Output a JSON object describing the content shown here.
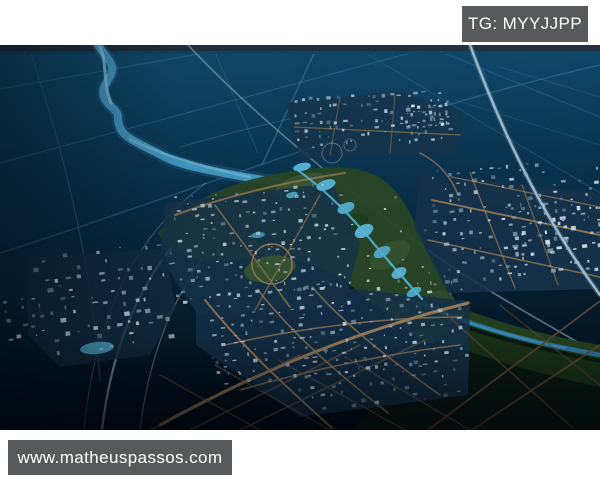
{
  "overlay": {
    "tg_label": "TG: MYYJJPP",
    "site_label": "www.matheuspassos.com"
  },
  "palette": {
    "page_bg": "#ffffff",
    "badge_bg": "#58595b",
    "badge_text": "#ffffff",
    "water_deep": "#0a3450",
    "river_blue": "#4aa4d2",
    "lake_cyan": "#5fc0e4",
    "park_green": "#2b4827",
    "city_road_tan": "#a8845c",
    "highway_light": "#aac8dc",
    "building_light": "#cfe0ec"
  },
  "scene": {
    "w": 600,
    "h": 385,
    "layers": [
      {
        "t": "lg",
        "id": "bgG",
        "x1": 0,
        "y1": 0,
        "x2": 0.12,
        "y2": 1,
        "st": [
          [
            0,
            "#125273",
            1
          ],
          [
            0.2,
            "#0e4362",
            1
          ],
          [
            0.4,
            "#0a3450",
            1
          ],
          [
            0.62,
            "#07263a",
            1
          ],
          [
            0.82,
            "#041827",
            1
          ],
          [
            1,
            "#020d16",
            1
          ]
        ]
      },
      {
        "t": "lg",
        "id": "fadeB",
        "x1": 0,
        "y1": 0,
        "x2": 0,
        "y2": 1,
        "st": [
          [
            0,
            "#000208",
            0
          ],
          [
            1,
            "#000208",
            0.6
          ]
        ]
      },
      {
        "t": "lg",
        "id": "fadeL",
        "x1": 0,
        "y1": 0,
        "x2": 1,
        "y2": 0,
        "st": [
          [
            0,
            "#000812",
            0.5
          ],
          [
            0.3,
            "#000812",
            0.1
          ],
          [
            1,
            "#000812",
            0
          ]
        ]
      },
      {
        "t": "r",
        "x": 0,
        "y": 0,
        "w": 600,
        "h": 385,
        "f": "url(#bgG)"
      },
      {
        "t": "p",
        "d": "M0,44 L250,0",
        "s": "#337aa0",
        "w": 1.2,
        "o": 0.5
      },
      {
        "t": "p",
        "d": "M0,118 L440,0",
        "s": "#337aa0",
        "w": 1.2,
        "o": 0.5
      },
      {
        "t": "p",
        "d": "M0,208 C160,158 380,70 600,20",
        "s": "#337aa0",
        "w": 1.4,
        "o": 0.55
      },
      {
        "t": "p",
        "d": "M28,0 C66,110 92,225 100,335",
        "s": "#337aa0",
        "w": 1.2,
        "o": 0.5
      },
      {
        "t": "p",
        "d": "M212,0 L258,108",
        "s": "#337aa0",
        "w": 1,
        "o": 0.45
      },
      {
        "t": "p",
        "d": "M318,0 L262,120",
        "s": "#6a92ac",
        "w": 1.2,
        "o": 0.5
      },
      {
        "t": "p",
        "d": "M425,0 L600,72",
        "s": "#337aa0",
        "w": 1,
        "o": 0.45
      },
      {
        "t": "p",
        "d": "M352,0 L600,148",
        "s": "#337aa0",
        "w": 1,
        "o": 0.4
      },
      {
        "t": "p",
        "d": "M500,22 L600,52",
        "s": "#337aa0",
        "w": 1,
        "o": 0.35
      },
      {
        "t": "p",
        "d": "M455,55 L600,100",
        "s": "#337aa0",
        "w": 1,
        "o": 0.3
      },
      {
        "t": "p",
        "d": "M180,102 C240,85 300,70 360,60",
        "s": "#3d82a8",
        "w": 1.1,
        "o": 0.45
      },
      {
        "t": "r",
        "x": 0,
        "y": 0,
        "w": 600,
        "h": 6,
        "f": "#223140"
      },
      {
        "t": "r",
        "x": 0,
        "y": 6,
        "w": 600,
        "h": 3,
        "f": "#0d4668",
        "o": 0.85
      },
      {
        "t": "p",
        "d": "M98,0 C104,10 114,18 112,26 C110,36 100,42 104,52 C108,62 118,64 118,72 C118,82 122,88 128,92 C136,98 150,104 165,112 C185,122 215,126 245,132 C262,135 272,136 282,138",
        "s": "#2d6e96",
        "w": 13,
        "o": 0.4
      },
      {
        "t": "p",
        "d": "M98,0 C104,10 114,18 112,26 C110,36 100,42 104,52 C108,62 118,64 118,72 C118,82 122,88 128,92 C136,98 150,104 165,112 C185,122 215,126 245,132 C262,135 272,136 282,138",
        "s": "#4aa4d2",
        "w": 8,
        "o": 0.95
      },
      {
        "t": "p",
        "d": "M100,2 C107,16 103,40 111,58",
        "s": "#8ed2ee",
        "w": 3,
        "o": 0.8
      },
      {
        "t": "p",
        "d": "M130,94 C152,106 200,122 250,132",
        "s": "#7cc6e6",
        "w": 2.5,
        "o": 0.7
      },
      {
        "t": "p",
        "d": "M228,148 C162,196 115,272 102,385",
        "s": "#9db9cc",
        "w": 2.2,
        "o": 0.8
      },
      {
        "t": "p",
        "d": "M252,160 C196,206 152,282 140,385",
        "s": "#9db9cc",
        "w": 1.2,
        "o": 0.5
      },
      {
        "t": "p",
        "d": "M206,138 C140,186 96,262 84,385",
        "s": "#9db9cc",
        "w": 1,
        "o": 0.4
      },
      {
        "t": "p",
        "d": "M188,0 C250,66 330,132 424,202 C475,240 545,278 600,310",
        "s": "#97b4c8",
        "w": 1.8,
        "o": 0.55
      },
      {
        "t": "p",
        "d": "M158,188 C190,152 240,134 292,126 C330,120 362,120 382,134 C402,148 412,172 424,196 C436,220 450,246 462,268 C470,282 474,292 476,302 C458,308 432,302 412,288 C392,274 368,254 348,238 C316,214 276,208 238,214 C206,219 172,212 158,188 Z",
        "f": "#2b4827",
        "o": 0.96
      },
      {
        "t": "e",
        "cx": 300,
        "cy": 140,
        "rx": 26,
        "ry": 10,
        "rot": -18,
        "f": "#41613a",
        "o": 0.7
      },
      {
        "t": "e",
        "cx": 390,
        "cy": 210,
        "rx": 22,
        "ry": 12,
        "rot": -30,
        "f": "#3b5a34",
        "o": 0.7
      },
      {
        "t": "e",
        "cx": 432,
        "cy": 258,
        "rx": 18,
        "ry": 10,
        "rot": -32,
        "f": "#35532f",
        "o": 0.7
      },
      {
        "t": "e",
        "cx": 350,
        "cy": 180,
        "rx": 20,
        "ry": 9,
        "rot": -25,
        "f": "#1e3a1c",
        "o": 0.6
      },
      {
        "t": "e",
        "cx": 255,
        "cy": 205,
        "rx": 24,
        "ry": 9,
        "rot": -8,
        "f": "#365433",
        "o": 0.6
      },
      {
        "t": "p",
        "d": "M352,385 L462,268 L600,302 L600,385 Z",
        "f": "#0a1a10",
        "o": 0.92
      },
      {
        "t": "p",
        "d": "M428,248 C470,268 520,286 600,300 L600,314 C520,298 468,282 420,264 Z",
        "f": "#26451f",
        "o": 0.9
      },
      {
        "t": "p",
        "d": "M420,268 C470,288 530,304 600,318 L600,342 C525,326 462,306 408,284 Z",
        "f": "#1c3417",
        "o": 0.9
      },
      {
        "t": "p",
        "d": "M420,258 C460,276 510,292 560,302 C575,305 590,308 600,310",
        "s": "#2c76a4",
        "w": 4.5,
        "o": 0.95
      },
      {
        "t": "p",
        "d": "M430,264 C470,280 520,294 565,303",
        "s": "#4696c2",
        "w": 1.8,
        "o": 0.7
      },
      {
        "t": "p",
        "d": "M286,58 L395,46 L462,66 L458,108 L300,114 Z",
        "f": "#17364e",
        "o": 0.85
      },
      {
        "t": "p",
        "d": "M420,128 L600,148 L600,244 L448,248 L414,182 Z",
        "f": "#16344c",
        "o": 0.85
      },
      {
        "t": "p",
        "d": "M165,158 L332,138 L360,198 L344,262 L198,270 L160,212 Z",
        "f": "#17364e",
        "o": 0.85
      },
      {
        "t": "p",
        "d": "M196,252 L345,243 L470,256 L468,350 L300,372 L240,330 L196,300 Z",
        "f": "#15324a",
        "o": 0.85
      },
      {
        "t": "p",
        "d": "M26,212 L164,204 L176,262 L150,310 L60,322 L28,290 Z",
        "f": "#152f45",
        "o": 0.8
      },
      {
        "t": "e",
        "cx": 270,
        "cy": 224,
        "rx": 26,
        "ry": 13,
        "rot": -10,
        "f": "#3c5c33",
        "o": 0.9
      },
      {
        "t": "c",
        "cx": 272,
        "cy": 219,
        "r": 20,
        "s": "#a8845c",
        "w": 1.4,
        "o": 0.9
      },
      {
        "t": "p",
        "d": "M160,380 C260,325 360,285 468,258",
        "s": "#a8845c",
        "w": 3,
        "o": 0.9
      },
      {
        "t": "p",
        "d": "M205,255 C245,305 290,345 332,383",
        "s": "#a8845c",
        "w": 2,
        "o": 0.85
      },
      {
        "t": "p",
        "d": "M258,245 C295,292 340,330 388,368",
        "s": "#9a7a52",
        "w": 1.6,
        "o": 0.8
      },
      {
        "t": "p",
        "d": "M312,242 C350,285 395,318 440,350",
        "s": "#9a7a52",
        "w": 1.6,
        "o": 0.8
      },
      {
        "t": "p",
        "d": "M225,300 C290,285 380,272 462,272",
        "s": "#9a7a52",
        "w": 1.6,
        "o": 0.8
      },
      {
        "t": "p",
        "d": "M240,345 C310,325 390,308 460,300",
        "s": "#9a7a52",
        "w": 1.6,
        "o": 0.8
      },
      {
        "t": "p",
        "d": "M175,170 C230,150 290,136 345,128",
        "s": "#9a7a52",
        "w": 2,
        "o": 0.85
      },
      {
        "t": "p",
        "d": "M215,160 L290,262",
        "s": "#9a7a52",
        "w": 1.5,
        "o": 0.8
      },
      {
        "t": "p",
        "d": "M320,150 L255,265",
        "s": "#9a7a52",
        "w": 1.3,
        "o": 0.75
      },
      {
        "t": "p",
        "d": "M432,155 L600,190",
        "s": "#a8845c",
        "w": 1.8,
        "o": 0.85
      },
      {
        "t": "p",
        "d": "M428,195 L600,232",
        "s": "#9a7a52",
        "w": 1.5,
        "o": 0.8
      },
      {
        "t": "p",
        "d": "M452,132 L600,162",
        "s": "#9a7a52",
        "w": 1.3,
        "o": 0.75
      },
      {
        "t": "p",
        "d": "M470,128 L515,243",
        "s": "#9a7a52",
        "w": 1.3,
        "o": 0.75
      },
      {
        "t": "p",
        "d": "M522,140 L558,240",
        "s": "#9a7a52",
        "w": 1.2,
        "o": 0.7
      },
      {
        "t": "p",
        "d": "M294,82 L460,90",
        "s": "#9a7a52",
        "w": 1.3,
        "o": 0.7
      },
      {
        "t": "p",
        "d": "M340,52 L330,110",
        "s": "#9a7a52",
        "w": 1,
        "o": 0.6
      },
      {
        "t": "p",
        "d": "M395,50 L390,108",
        "s": "#9a7a52",
        "w": 1,
        "o": 0.6
      },
      {
        "t": "p",
        "d": "M420,108 C440,118 452,134 458,150",
        "s": "#9a7a52",
        "w": 1.5,
        "o": 0.8
      },
      {
        "t": "p",
        "d": "M150,385 L300,310",
        "s": "#7a6148",
        "w": 1.6,
        "o": 0.6
      },
      {
        "t": "p",
        "d": "M190,385 L360,300",
        "s": "#7a6148",
        "w": 1.6,
        "o": 0.6
      },
      {
        "t": "p",
        "d": "M240,385 L425,295",
        "s": "#7a6148",
        "w": 1.6,
        "o": 0.6
      },
      {
        "t": "p",
        "d": "M160,330 L260,385",
        "s": "#7a6148",
        "w": 1.4,
        "o": 0.55
      },
      {
        "t": "p",
        "d": "M215,320 L330,385",
        "s": "#7a6148",
        "w": 1.4,
        "o": 0.55
      },
      {
        "t": "p",
        "d": "M278,315 L405,385",
        "s": "#7a6148",
        "w": 1.4,
        "o": 0.55
      },
      {
        "t": "p",
        "d": "M345,312 L470,385",
        "s": "#7a6148",
        "w": 1.4,
        "o": 0.55
      },
      {
        "t": "c",
        "cx": 332,
        "cy": 108,
        "r": 10,
        "s": "#9db9cc",
        "w": 1,
        "o": 0.5
      },
      {
        "t": "c",
        "cx": 350,
        "cy": 100,
        "r": 6,
        "s": "#9db9cc",
        "w": 1,
        "o": 0.4
      },
      {
        "t": "p",
        "d": "M428,385 L600,256",
        "s": "#5f4536",
        "w": 2,
        "o": 0.85
      },
      {
        "t": "p",
        "d": "M472,385 L600,300",
        "s": "#5f4536",
        "w": 2,
        "o": 0.8
      },
      {
        "t": "p",
        "d": "M438,262 L575,385",
        "s": "#5f4536",
        "w": 1.6,
        "o": 0.7
      },
      {
        "t": "p",
        "d": "M500,260 L600,340",
        "s": "#5f4536",
        "w": 1.4,
        "o": 0.6
      },
      {
        "t": "p",
        "d": "M296,124 C322,142 348,168 370,194 C388,216 406,236 422,254",
        "s": "#58bce0",
        "w": 2.2,
        "o": 0.9
      },
      {
        "t": "e",
        "cx": 302,
        "cy": 122,
        "rx": 9,
        "ry": 4,
        "rot": -12,
        "f": "#5fc0e4",
        "o": 0.95
      },
      {
        "t": "e",
        "cx": 326,
        "cy": 140,
        "rx": 10,
        "ry": 5,
        "rot": -20,
        "f": "#5fc0e4",
        "o": 0.95
      },
      {
        "t": "e",
        "cx": 346,
        "cy": 163,
        "rx": 9,
        "ry": 5,
        "rot": -24,
        "f": "#54b6da",
        "o": 0.95
      },
      {
        "t": "e",
        "cx": 364,
        "cy": 186,
        "rx": 10,
        "ry": 6,
        "rot": -28,
        "f": "#5fc0e4",
        "o": 0.95
      },
      {
        "t": "e",
        "cx": 382,
        "cy": 207,
        "rx": 9,
        "ry": 5,
        "rot": -28,
        "f": "#54b6da",
        "o": 0.9
      },
      {
        "t": "e",
        "cx": 399,
        "cy": 228,
        "rx": 8,
        "ry": 5,
        "rot": -30,
        "f": "#5fc0e4",
        "o": 0.9
      },
      {
        "t": "e",
        "cx": 414,
        "cy": 247,
        "rx": 8,
        "ry": 4,
        "rot": -30,
        "f": "#54b6da",
        "o": 0.9
      },
      {
        "t": "e",
        "cx": 292,
        "cy": 150,
        "rx": 6,
        "ry": 3,
        "rot": -12,
        "f": "#54b6da",
        "o": 0.85
      },
      {
        "t": "e",
        "cx": 258,
        "cy": 190,
        "rx": 7,
        "ry": 3,
        "rot": -8,
        "f": "#4eaed2",
        "o": 0.8
      },
      {
        "t": "e",
        "cx": 97,
        "cy": 303,
        "rx": 17,
        "ry": 6,
        "rot": -6,
        "f": "#54b6da",
        "o": 0.9
      },
      {
        "t": "b",
        "x": 292,
        "y": 52,
        "w": 160,
        "h": 54,
        "rot": -3,
        "cols": 20,
        "rows": 7,
        "dens": 0.55,
        "size": 5,
        "f": "#b8cfe0",
        "seed": 11
      },
      {
        "t": "b",
        "x": 404,
        "y": 60,
        "w": 46,
        "h": 26,
        "rot": -3,
        "cols": 8,
        "rows": 4,
        "dens": 0.8,
        "size": 5,
        "f": "#ecf5fb",
        "seed": 12
      },
      {
        "t": "b",
        "x": 428,
        "y": 126,
        "w": 172,
        "h": 118,
        "rot": -5,
        "cols": 20,
        "rows": 12,
        "dens": 0.5,
        "size": 5,
        "f": "#c4d7e5",
        "seed": 13
      },
      {
        "t": "b",
        "x": 506,
        "y": 158,
        "w": 94,
        "h": 58,
        "rot": -7,
        "cols": 11,
        "rows": 6,
        "dens": 0.7,
        "size": 6,
        "f": "#e2eef7",
        "seed": 14
      },
      {
        "t": "b",
        "x": 172,
        "y": 150,
        "w": 172,
        "h": 112,
        "rot": -5,
        "cols": 20,
        "rows": 11,
        "dens": 0.55,
        "size": 5,
        "f": "#cbdde9",
        "seed": 15
      },
      {
        "t": "b",
        "x": 205,
        "y": 250,
        "w": 258,
        "h": 95,
        "rot": -6,
        "cols": 26,
        "rows": 10,
        "dens": 0.6,
        "size": 5,
        "f": "#bdd2e2",
        "seed": 16
      },
      {
        "t": "b",
        "x": 295,
        "y": 330,
        "w": 165,
        "h": 40,
        "rot": -6,
        "cols": 16,
        "rows": 4,
        "dens": 0.6,
        "size": 5,
        "f": "#b5cadb",
        "seed": 20
      },
      {
        "t": "b",
        "x": 30,
        "y": 212,
        "w": 146,
        "h": 106,
        "rot": -8,
        "cols": 14,
        "rows": 10,
        "dens": 0.5,
        "size": 6,
        "f": "#d9e8f2",
        "seed": 17
      },
      {
        "t": "b",
        "x": 2,
        "y": 252,
        "w": 34,
        "h": 46,
        "rot": -6,
        "cols": 4,
        "rows": 5,
        "dens": 0.5,
        "size": 5,
        "f": "#cfe0ec",
        "seed": 18
      },
      {
        "t": "b",
        "x": 180,
        "y": 150,
        "w": 280,
        "h": 200,
        "rot": -5,
        "cols": 24,
        "rows": 16,
        "dens": 0.1,
        "size": 2.4,
        "f": "#ffffff",
        "seed": 19
      },
      {
        "t": "p",
        "d": "M470,0 C505,95 545,175 600,250",
        "s": "#6d93ab",
        "w": 5,
        "o": 0.35
      },
      {
        "t": "p",
        "d": "M470,0 C505,95 545,175 600,250",
        "s": "#aac8dc",
        "w": 2.4,
        "o": 0.9
      },
      {
        "t": "r",
        "x": 0,
        "y": 290,
        "w": 600,
        "h": 95,
        "f": "url(#fadeB)"
      },
      {
        "t": "r",
        "x": 0,
        "y": 0,
        "w": 600,
        "h": 385,
        "f": "url(#fadeL)"
      }
    ]
  }
}
